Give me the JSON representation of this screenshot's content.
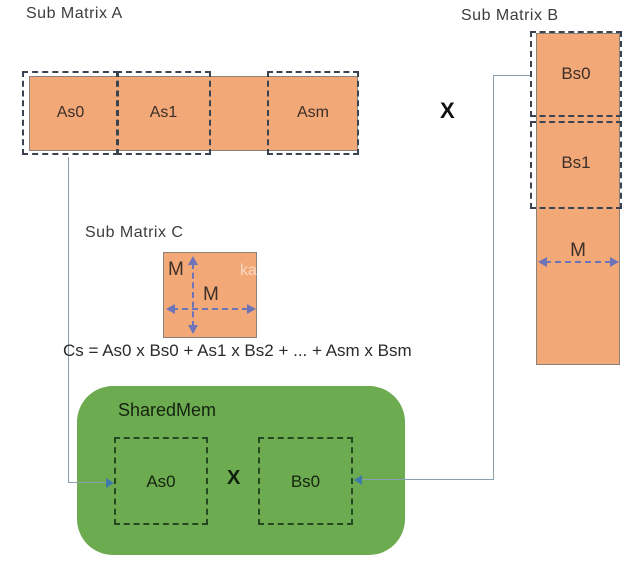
{
  "colors": {
    "matrix_fill": "#f3a878",
    "matrix_border": "#8b8178",
    "dashed_border": "#3a4450",
    "green_fill": "#6cab50",
    "green_dashed": "#24481f",
    "green_text": "#14230f",
    "connector": "#8aa0ae",
    "arrowhead": "#3f7cac",
    "dim_arrow": "#6f74b8",
    "cell_text": "#3b2f28",
    "title_text": "#3d3d3d",
    "formula_text": "#2b2b2b"
  },
  "matrix_a": {
    "title": "Sub Matrix A",
    "cells": [
      "As0",
      "As1",
      "Asm"
    ]
  },
  "matrix_b": {
    "title": "Sub Matrix B",
    "cells": [
      "Bs0",
      "Bs1"
    ],
    "dim_label": "M"
  },
  "matrix_c": {
    "title": "Sub Matrix C",
    "dim_label_vertical": "M",
    "dim_label_horizontal": "M",
    "watermark": "ka"
  },
  "multiply_sign": "X",
  "formula": "Cs = As0 x Bs0 + As1 x Bs2 + ... + Asm x Bsm",
  "shared_mem": {
    "title": "SharedMem",
    "left_cell": "As0",
    "multiply_sign": "X",
    "right_cell": "Bs0"
  }
}
